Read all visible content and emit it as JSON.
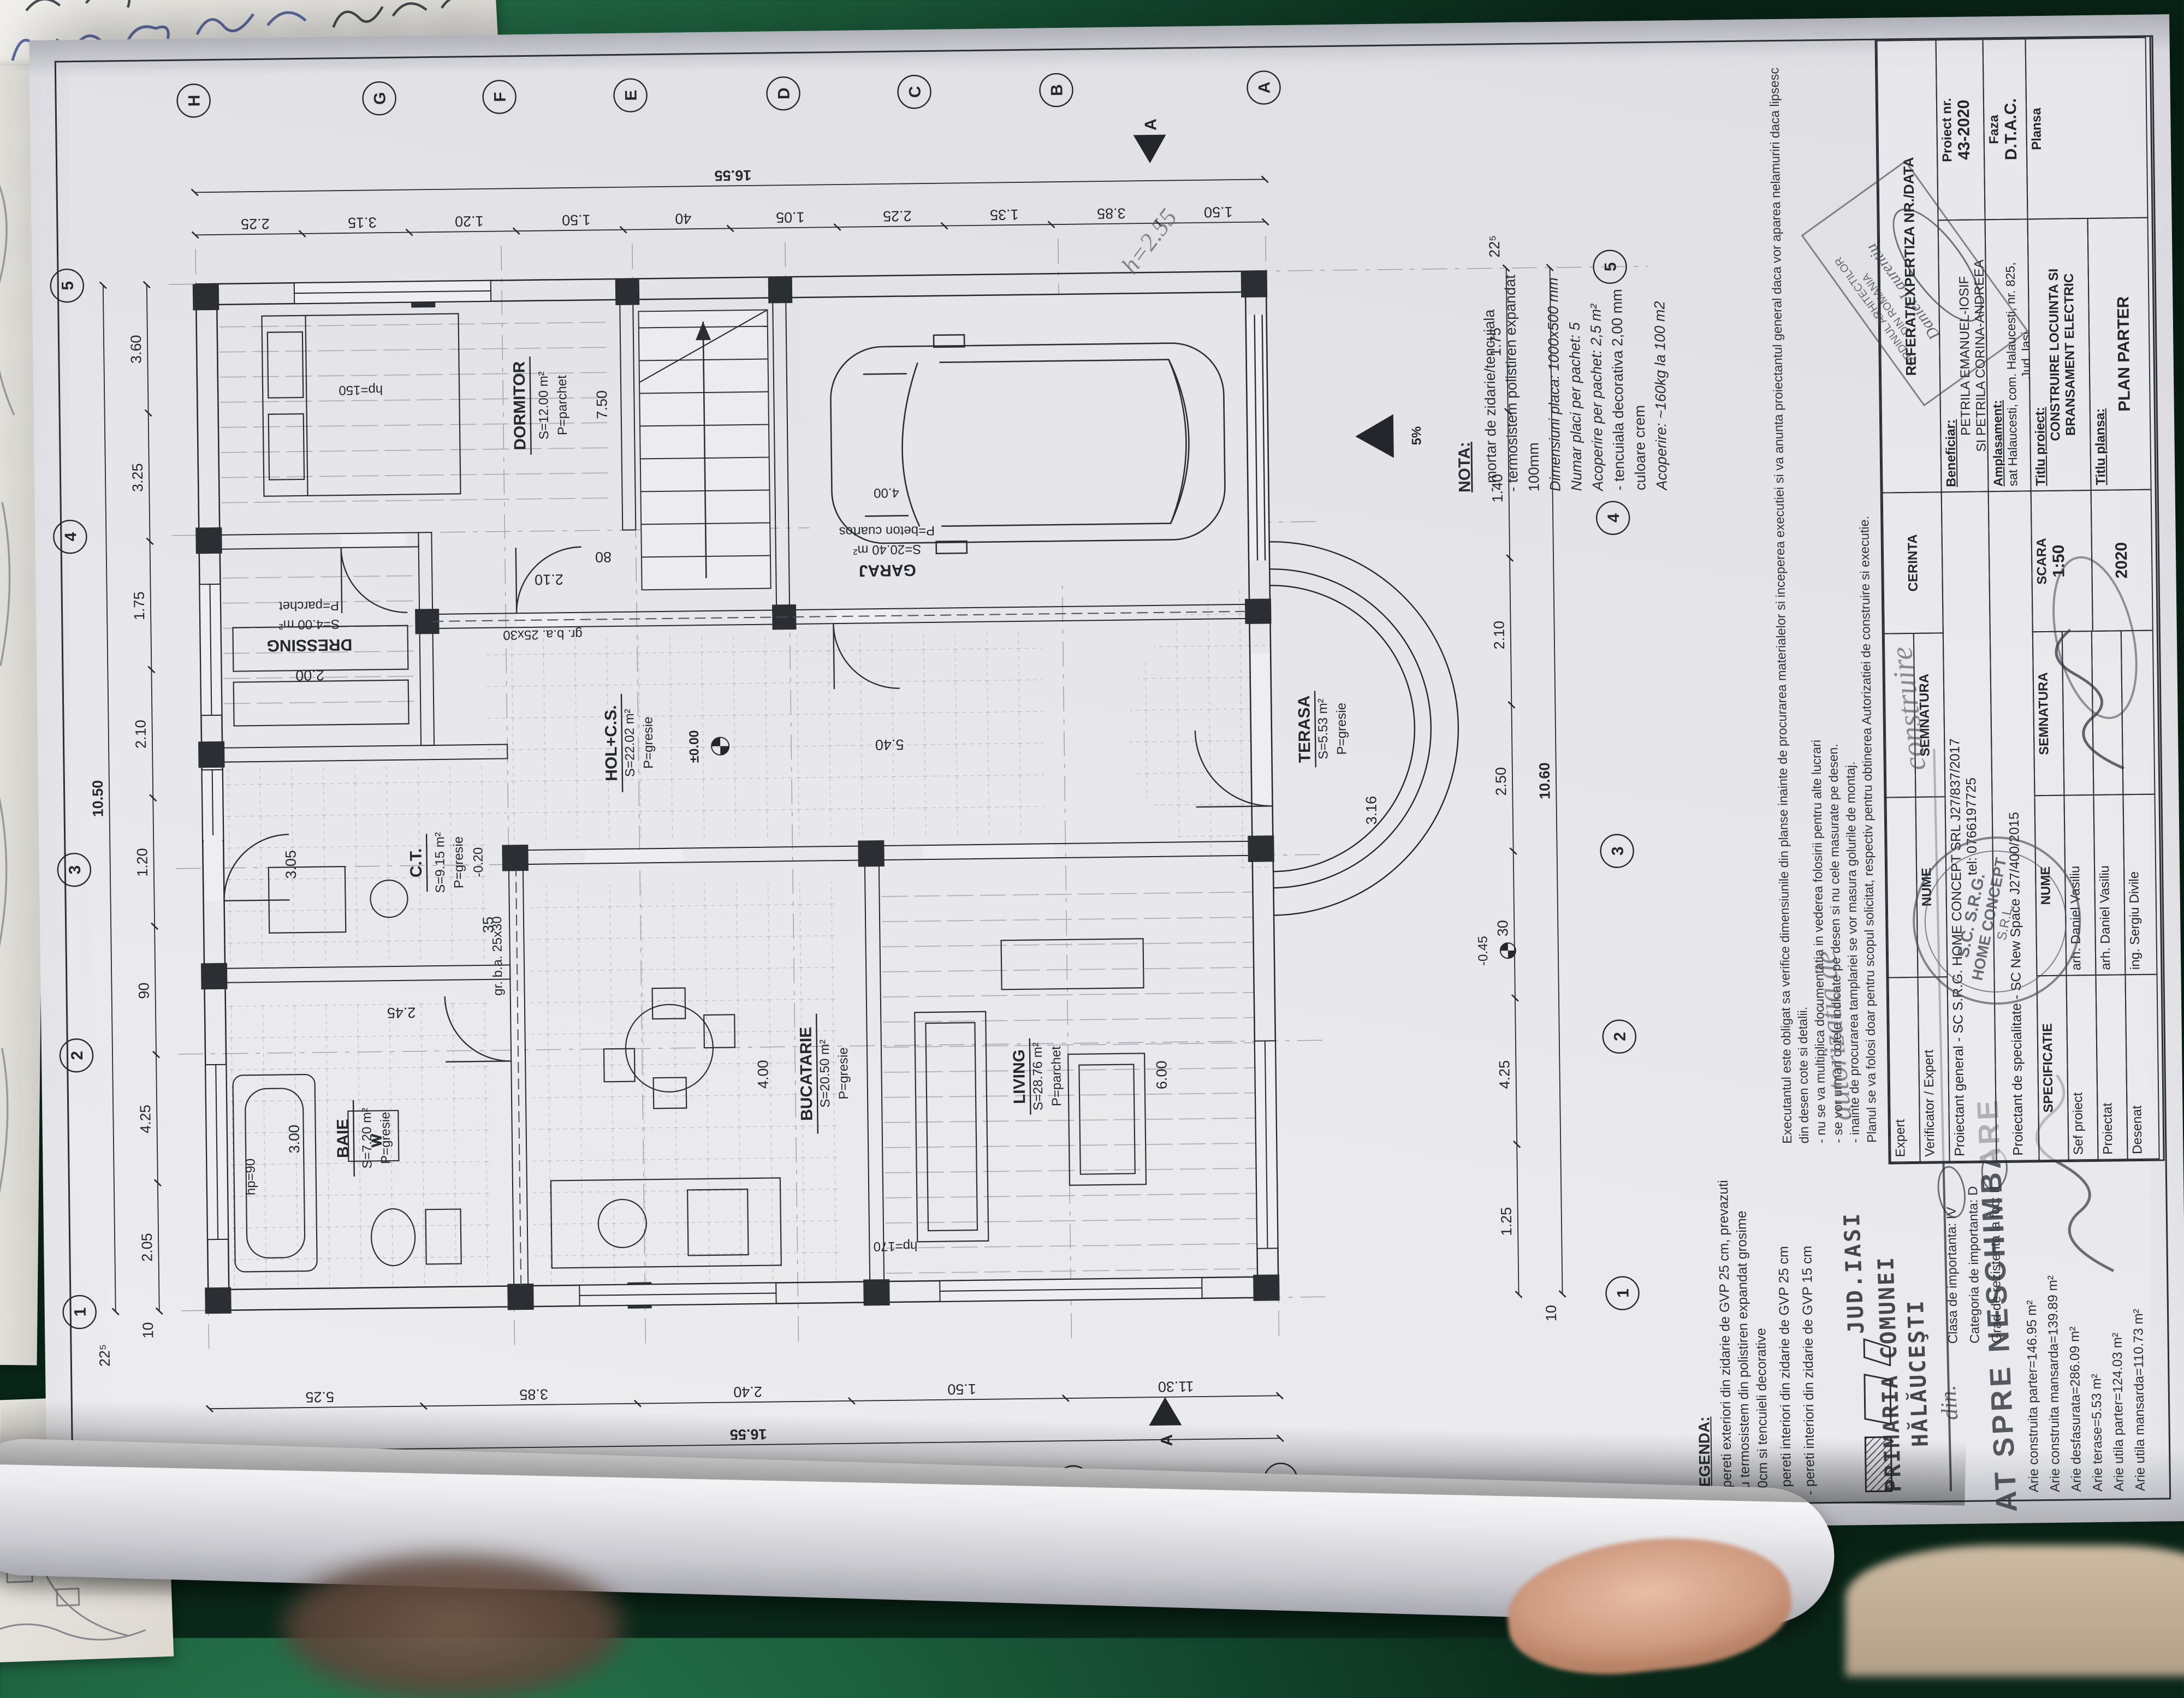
{
  "colors": {
    "felt_green": "#1c5f3d",
    "paper": "#e9e9ec",
    "ink": "#23262b",
    "stamp_ink": "#3a3f48",
    "pencil": "#5c6066",
    "skin": "#d4a18b"
  },
  "plan": {
    "rooms": [
      {
        "name": "BAIE",
        "area": "S=7.20 m²",
        "floor": "P=gresie"
      },
      {
        "name": "C.T.",
        "area": "S=9.15 m²",
        "floor": "P=gresie",
        "level": "-0.20"
      },
      {
        "name": "DRESSING",
        "area": "S=4.00 m²",
        "floor": "P=parchet"
      },
      {
        "name": "DORMITOR",
        "area": "S=12.00 m²",
        "floor": "P=parchet"
      },
      {
        "name": "BUCATARIE",
        "area": "S=20.50 m²",
        "floor": "P=gresie"
      },
      {
        "name": "HOL+C.S.",
        "area": "S=22.02 m²",
        "floor": "P=gresie"
      },
      {
        "name": "LIVING",
        "area": "S=28.76 m²",
        "floor": "P=parchet"
      },
      {
        "name": "GARAJ",
        "area": "S=20.40 m²",
        "floor": "P=beton cuartos"
      },
      {
        "name": "TERASA",
        "area": "S=5.53 m²",
        "floor": "P=gresie"
      }
    ],
    "levels": {
      "zero": "±0.00",
      "ct": "-0.20",
      "ext": "-0.45"
    },
    "slope": "5%",
    "section": "A",
    "beam": "gr. b.a. 25x30",
    "windows": {
      "w1": "hp=90",
      "w2": "hp=150",
      "w3": "hp=170"
    },
    "axisLetters": [
      "H",
      "G",
      "F",
      "E",
      "D",
      "C",
      "B",
      "A"
    ],
    "axisNumbers": [
      "1",
      "2",
      "3",
      "4",
      "5"
    ],
    "dims": {
      "topOuter": [
        "10.50"
      ],
      "topInner": [
        "2.05",
        "4.25",
        "90",
        "1.20",
        "2.10",
        "1.75",
        "3.25",
        "3.60"
      ],
      "rightOuter": [
        "16.55"
      ],
      "rightInner": [
        "2.25",
        "3.15",
        "1.20",
        "1.50",
        "40",
        "1.05",
        "2.25",
        "1.35",
        "3.85",
        "1.50"
      ],
      "leftOuter": [
        "16.55"
      ],
      "leftInner": [
        "5.25",
        "3.85",
        "2.40",
        "1.50",
        "11.30"
      ],
      "bottomOuter": [
        "10.60"
      ],
      "bottomInner": [
        "1.25",
        "4.25",
        "30",
        "2.50",
        "2.10",
        "1.40",
        "1.75"
      ],
      "corners": [
        "10",
        "22⁵",
        "10",
        "22⁵"
      ],
      "interior": [
        "4.00",
        "6.00",
        "5.40",
        "2.00",
        "3.00",
        "3.05",
        "2.45",
        "2.10",
        "80",
        "35",
        "3.16",
        "7.50"
      ]
    }
  },
  "nota": {
    "title": "NOTA:",
    "l1": "- mortar de zidarie/tencuiala",
    "l2": "- termosistem polistiren expandat",
    "l3": "100mm",
    "l4": "Dimensiuni placa: 1000x500 mm",
    "l5": "Numar placi per pachet: 5",
    "l6": "Acoperire per pachet: 2,5 m²",
    "l7": "- tencuiala decorativa 2,00 mm",
    "l8": "culoare crem",
    "l9": "Acoperire: ~160kg la 100 m2"
  },
  "legend": {
    "title": "LEGENDA:",
    "i1": "- pereti exteriori din zidarie de GVP 25 cm, prevazuti cu termosistem din polistiren expandat grosime 10cm si tencuieli decorative",
    "i2": "- pereti interiori din zidarie de GVP 25 cm",
    "i3": "- pereti interiori din zidarie de GVP 15 cm"
  },
  "classNotes": {
    "c1": "Clasa de importanta: IV",
    "c2": "Categoria de importanta: D",
    "c3": "Grad de rezistenta la foc: II"
  },
  "areas": {
    "a1": "Arie construita parter=146.95 m²",
    "a2": "Arie construita mansarda=139.89 m²",
    "a3": "Arie desfasurata=286.09 m²",
    "a4": "Arie terase=5.53 m²",
    "a5": "Arie utila parter=124.03 m²",
    "a6": "Arie utila mansarda=110.73 m²"
  },
  "paragraph": {
    "p1": "Executantul este obligat sa verifice dimensiunile din planse inainte de procurarea materialelor si inceperea executiei si va anunta proiectantul general daca vor aparea nelamuriri daca lipsesc din desen cote si detalii.",
    "p2": "- nu se va multiplica documentatia in vederea folosirii pentru alte lucrari",
    "p3": "- se vor urmari cotele indicate pe desen si nu cele masurate pe desen.",
    "p4": "- inainte de procurarea tamplariei se vor masura golurile de montaj.",
    "p5": "Planul se va folosi doar pentru scopul solicitat, respectiv pentru obtinerea Autorizatiei de construire si executie."
  },
  "stamps": {
    "jud": "JUD.IASI",
    "prim1": "PRIMARIA COMUNEI",
    "prim2": "HĂLĂUCEŞTI",
    "viza": "AT SPRE NESCHIMBARE",
    "srg1": "S.C. S.R.G.",
    "srg2": "HOME CONCEPT",
    "srg3": "S.R.L.",
    "oar1": "ORDINUL ARHITECTILOR",
    "oar2": "DIN ROMANIA",
    "oarName": "Daniel-Laurentiu"
  },
  "handwriting": {
    "h1": "autorizatia de",
    "h2": "construire",
    "h3": "din.",
    "h4": "h=2.55"
  },
  "cartus": {
    "expert": "Expert",
    "verificator": "Verificator / Expert",
    "nume": "NUME",
    "semnatura": "SEMNATURA",
    "cerinta": "CERINTA",
    "referat": "REFERAT/EXPERTIZA NR./DATA",
    "pg1": "Proiectant general - SC S.R.G. HOME CONCEPT SRL J27/837/2017",
    "pg2": "tel: 0766197725",
    "ps": "Proiectant de specialitate - SC New Space J27/400/2015",
    "benLabel": "Beneficiar:",
    "ben1": "PETRILA EMANUEL-IOSIF",
    "ben2": "SI PETRILA CORINA-ANDREEA",
    "ampLabel": "Amplasament:",
    "amp1": "sat Halaucesti, com. Halaucesti, nr. 825,",
    "amp2": "Jud. Iasi",
    "prLabel": "Proiect nr.",
    "prVal": "43-2020",
    "fazaLabel": "Faza",
    "fazaVal": "D.T.A.C.",
    "plansaLabel": "Plansa",
    "scaraLabel": "SCARA",
    "scaraVal": "1:50",
    "dataVal": "2020",
    "spec": "SPECIFICATIE",
    "r1l": "Sef proiect",
    "r1n": "arh. Daniel Vasiliu",
    "r2l": "Proiectat",
    "r2n": "arh. Daniel Vasiliu",
    "r3l": "Desenat",
    "r3n": "ing. Sergiu Divile",
    "tpLabel": "Titlu proiect:",
    "tpVal": "CONSTRUIRE LOCUINTA SI BRANSAMENT ELECTRIC",
    "tplLabel": "Titlu plansa:",
    "tplVal": "PLAN PARTER"
  }
}
